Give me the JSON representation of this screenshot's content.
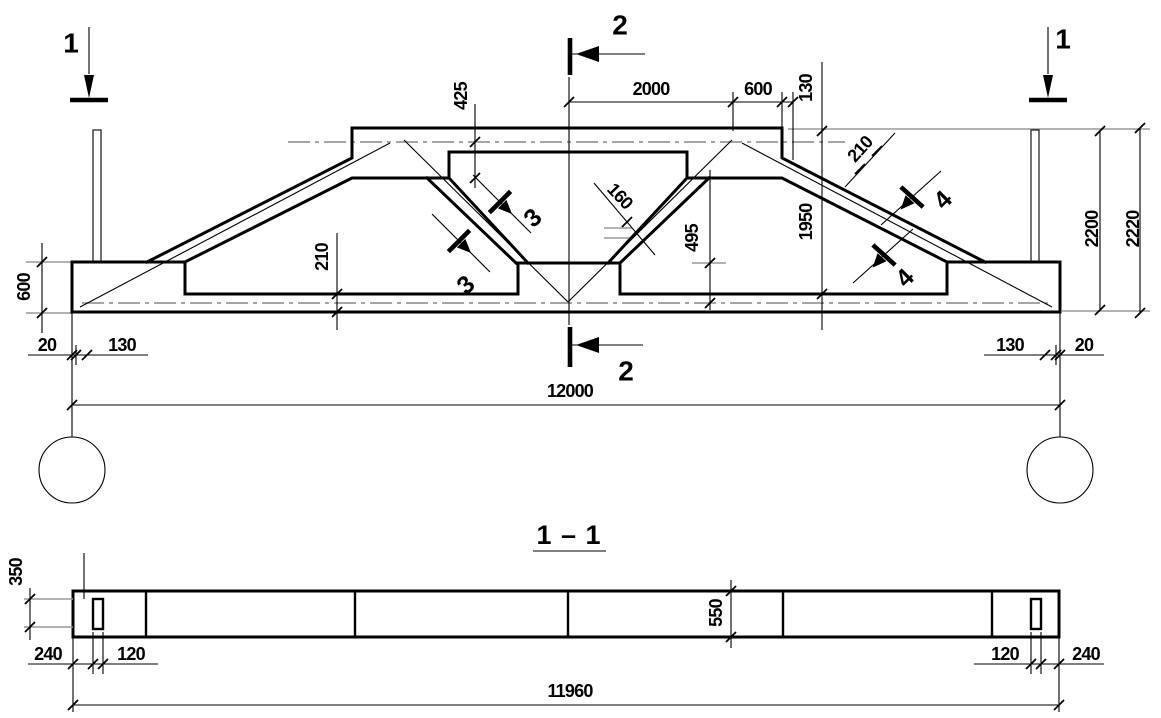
{
  "elevation": {
    "dims": {
      "top_axis_offset": "425",
      "top_center_span": "2000",
      "top_right_span": "600",
      "top_edge_offset": "130",
      "slope_thickness": "210",
      "inner_height": "1950",
      "chord_height": "2200",
      "total_height": "2220",
      "diagonal_thickness": "160",
      "pedestal_offset": "495",
      "bottom_chord_thickness": "210",
      "end_block_height": "600",
      "left_end_gap": "20",
      "left_axis_inset": "130",
      "right_axis_inset": "130",
      "right_end_gap": "20",
      "span": "12000"
    },
    "markers": {
      "section1_left": "1",
      "section1_right": "1",
      "section2_top": "2",
      "section2_bottom": "2",
      "cut3_upper": "3",
      "cut3_lower": "3",
      "cut4_upper": "4",
      "cut4_lower": "4"
    }
  },
  "section_view": {
    "title": "1 – 1",
    "dims": {
      "slot_height": "350",
      "beam_depth": "550",
      "left_end": "240",
      "left_slot": "120",
      "right_slot": "120",
      "right_end": "240",
      "length": "11960"
    }
  },
  "colors": {
    "ink": "#000000",
    "centerline": "#9a9a9a",
    "paper": "#ffffff"
  }
}
